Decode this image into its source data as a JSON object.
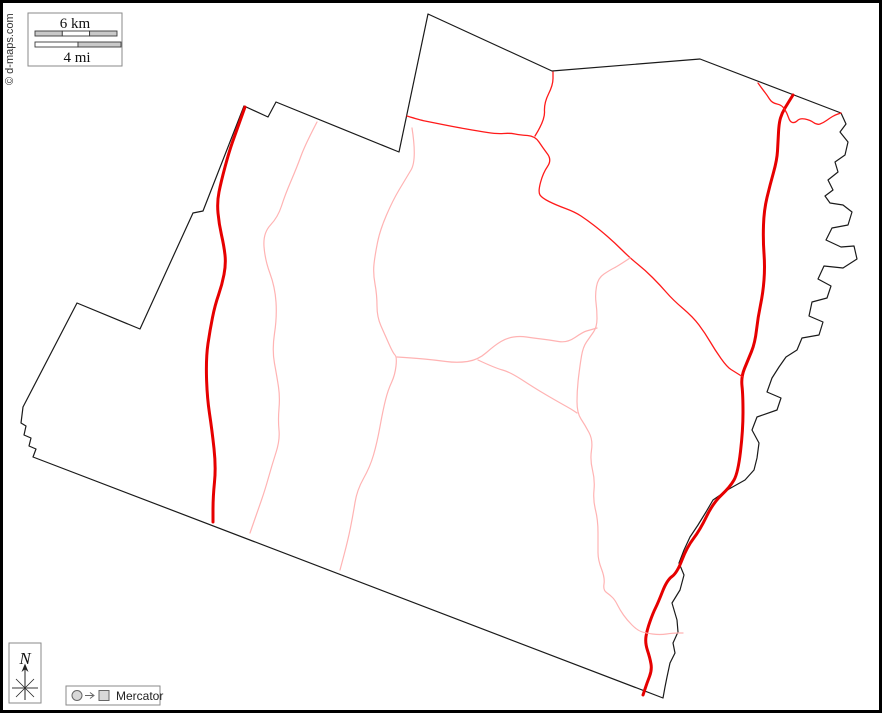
{
  "copyright": "© d-maps.com",
  "scale_bar": {
    "km_label": "6 km",
    "mi_label": "4 mi"
  },
  "north_label": "N",
  "projection_label": "Mercator",
  "colors": {
    "frame": "#000000",
    "boundary": "#1a1a1a",
    "road_major": "#e60000",
    "road_minor": "#ff1a1a",
    "road_light": "#ffb3b3"
  },
  "stroke_widths": {
    "boundary": 1.2,
    "road_major": 3,
    "road_minor": 1.3,
    "road_light": 1.2
  },
  "map": {
    "width": 882,
    "height": 713,
    "features": [
      {
        "name": "county-boundary",
        "layer": "boundary",
        "closed": true,
        "smooth": false,
        "points": [
          [
            244,
            106
          ],
          [
            268,
            117
          ],
          [
            276,
            102
          ],
          [
            399,
            152
          ],
          [
            428,
            14
          ],
          [
            552,
            71
          ],
          [
            700,
            59
          ],
          [
            841,
            113
          ],
          [
            846,
            124
          ],
          [
            840,
            132
          ],
          [
            848,
            142
          ],
          [
            845,
            155
          ],
          [
            835,
            162
          ],
          [
            838,
            172
          ],
          [
            828,
            180
          ],
          [
            833,
            190
          ],
          [
            825,
            196
          ],
          [
            830,
            203
          ],
          [
            843,
            205
          ],
          [
            852,
            212
          ],
          [
            848,
            225
          ],
          [
            832,
            228
          ],
          [
            826,
            240
          ],
          [
            841,
            247
          ],
          [
            854,
            246
          ],
          [
            857,
            259
          ],
          [
            843,
            268
          ],
          [
            824,
            266
          ],
          [
            818,
            279
          ],
          [
            831,
            286
          ],
          [
            827,
            298
          ],
          [
            812,
            302
          ],
          [
            809,
            316
          ],
          [
            823,
            322
          ],
          [
            819,
            335
          ],
          [
            802,
            338
          ],
          [
            797,
            350
          ],
          [
            786,
            357
          ],
          [
            779,
            367
          ],
          [
            772,
            378
          ],
          [
            767,
            392
          ],
          [
            781,
            398
          ],
          [
            777,
            410
          ],
          [
            757,
            417
          ],
          [
            752,
            430
          ],
          [
            759,
            443
          ],
          [
            757,
            458
          ],
          [
            754,
            470
          ],
          [
            745,
            480
          ],
          [
            729,
            489
          ],
          [
            713,
            500
          ],
          [
            706,
            512
          ],
          [
            698,
            525
          ],
          [
            690,
            537
          ],
          [
            684,
            550
          ],
          [
            679,
            563
          ],
          [
            684,
            575
          ],
          [
            680,
            590
          ],
          [
            672,
            603
          ],
          [
            677,
            620
          ],
          [
            678,
            632
          ],
          [
            673,
            643
          ],
          [
            675,
            653
          ],
          [
            670,
            663
          ],
          [
            667,
            677
          ],
          [
            665,
            687
          ],
          [
            663,
            698
          ],
          [
            33,
            457
          ],
          [
            36,
            449
          ],
          [
            29,
            446
          ],
          [
            31,
            438
          ],
          [
            24,
            435
          ],
          [
            26,
            426
          ],
          [
            21,
            423
          ],
          [
            23,
            407
          ],
          [
            77,
            303
          ],
          [
            140,
            329
          ],
          [
            193,
            213
          ],
          [
            203,
            211
          ]
        ]
      },
      {
        "name": "major-road-west",
        "layer": "road_major",
        "closed": false,
        "smooth": true,
        "points": [
          [
            245,
            107
          ],
          [
            236,
            132
          ],
          [
            229,
            152
          ],
          [
            221,
            182
          ],
          [
            217,
            202
          ],
          [
            219,
            224
          ],
          [
            224,
            246
          ],
          [
            226,
            264
          ],
          [
            222,
            285
          ],
          [
            215,
            305
          ],
          [
            210,
            330
          ],
          [
            206,
            357
          ],
          [
            207,
            397
          ],
          [
            212,
            430
          ],
          [
            216,
            467
          ],
          [
            213,
            497
          ],
          [
            213,
            522
          ]
        ]
      },
      {
        "name": "major-road-east",
        "layer": "road_major",
        "closed": false,
        "smooth": true,
        "points": [
          [
            793,
            95
          ],
          [
            788,
            103
          ],
          [
            782,
            113
          ],
          [
            779,
            123
          ],
          [
            778,
            142
          ],
          [
            777,
            160
          ],
          [
            770,
            185
          ],
          [
            764,
            210
          ],
          [
            763,
            240
          ],
          [
            765,
            267
          ],
          [
            763,
            293
          ],
          [
            758,
            317
          ],
          [
            755,
            343
          ],
          [
            748,
            360
          ],
          [
            741,
            377
          ],
          [
            743,
            395
          ],
          [
            743,
            430
          ],
          [
            738,
            473
          ],
          [
            730,
            487
          ],
          [
            713,
            503
          ],
          [
            700,
            530
          ],
          [
            687,
            547
          ],
          [
            677,
            573
          ],
          [
            667,
            580
          ],
          [
            658,
            603
          ],
          [
            653,
            613
          ],
          [
            647,
            630
          ],
          [
            645,
            643
          ],
          [
            650,
            658
          ],
          [
            652,
            670
          ],
          [
            647,
            683
          ],
          [
            643,
            695
          ]
        ]
      },
      {
        "name": "minor-road-north",
        "layer": "road_minor",
        "closed": false,
        "smooth": true,
        "points": [
          [
            407,
            116
          ],
          [
            420,
            120
          ],
          [
            430,
            122
          ],
          [
            455,
            127
          ],
          [
            478,
            131
          ],
          [
            497,
            134
          ],
          [
            510,
            133
          ],
          [
            520,
            135
          ],
          [
            535,
            136
          ],
          [
            543,
            148
          ],
          [
            552,
            160
          ],
          [
            543,
            173
          ],
          [
            538,
            192
          ],
          [
            542,
            198
          ],
          [
            556,
            205
          ],
          [
            575,
            212
          ],
          [
            587,
            220
          ],
          [
            600,
            230
          ],
          [
            615,
            243
          ],
          [
            630,
            258
          ],
          [
            645,
            270
          ],
          [
            660,
            285
          ],
          [
            673,
            300
          ],
          [
            693,
            317
          ],
          [
            705,
            333
          ],
          [
            715,
            350
          ],
          [
            727,
            367
          ],
          [
            735,
            372
          ],
          [
            743,
            377
          ]
        ]
      },
      {
        "name": "minor-road-north-branch",
        "layer": "road_minor",
        "closed": false,
        "smooth": true,
        "points": [
          [
            535,
            136
          ],
          [
            545,
            120
          ],
          [
            544,
            103
          ],
          [
            553,
            85
          ],
          [
            553,
            72
          ]
        ]
      },
      {
        "name": "minor-road-ne-connector",
        "layer": "road_minor",
        "closed": false,
        "smooth": true,
        "points": [
          [
            758,
            83
          ],
          [
            763,
            90
          ],
          [
            767,
            95
          ],
          [
            772,
            103
          ],
          [
            782,
            105
          ],
          [
            787,
            113
          ],
          [
            790,
            122
          ],
          [
            795,
            123
          ],
          [
            800,
            118
          ],
          [
            810,
            120
          ],
          [
            817,
            125
          ],
          [
            823,
            123
          ],
          [
            830,
            118
          ],
          [
            835,
            115
          ],
          [
            841,
            113
          ]
        ]
      },
      {
        "name": "light-road-west",
        "layer": "road_light",
        "closed": false,
        "smooth": true,
        "points": [
          [
            317,
            122
          ],
          [
            305,
            145
          ],
          [
            297,
            167
          ],
          [
            285,
            195
          ],
          [
            278,
            217
          ],
          [
            263,
            233
          ],
          [
            265,
            260
          ],
          [
            275,
            287
          ],
          [
            277,
            317
          ],
          [
            272,
            350
          ],
          [
            277,
            377
          ],
          [
            280,
            397
          ],
          [
            278,
            420
          ],
          [
            280,
            440
          ],
          [
            272,
            465
          ],
          [
            265,
            490
          ],
          [
            258,
            510
          ],
          [
            250,
            533
          ]
        ]
      },
      {
        "name": "light-road-center",
        "layer": "road_light",
        "closed": false,
        "smooth": true,
        "points": [
          [
            412,
            128
          ],
          [
            417,
            160
          ],
          [
            405,
            180
          ],
          [
            393,
            200
          ],
          [
            380,
            230
          ],
          [
            375,
            255
          ],
          [
            373,
            273
          ],
          [
            377,
            295
          ],
          [
            377,
            317
          ],
          [
            385,
            335
          ],
          [
            393,
            353
          ],
          [
            397,
            357
          ],
          [
            395,
            375
          ],
          [
            388,
            390
          ],
          [
            383,
            410
          ],
          [
            377,
            443
          ],
          [
            370,
            467
          ],
          [
            357,
            490
          ],
          [
            353,
            515
          ],
          [
            348,
            540
          ],
          [
            340,
            570
          ]
        ]
      },
      {
        "name": "light-road-cross-east",
        "layer": "road_light",
        "closed": false,
        "smooth": true,
        "points": [
          [
            397,
            357
          ],
          [
            413,
            358
          ],
          [
            435,
            360
          ],
          [
            457,
            363
          ],
          [
            478,
            360
          ],
          [
            495,
            345
          ],
          [
            507,
            338
          ],
          [
            520,
            336
          ],
          [
            533,
            338
          ],
          [
            550,
            340
          ],
          [
            567,
            343
          ],
          [
            583,
            332
          ],
          [
            590,
            330
          ],
          [
            597,
            328
          ]
        ]
      },
      {
        "name": "light-road-cross-southeast",
        "layer": "road_light",
        "closed": false,
        "smooth": true,
        "points": [
          [
            478,
            360
          ],
          [
            495,
            368
          ],
          [
            510,
            372
          ],
          [
            533,
            387
          ],
          [
            548,
            396
          ],
          [
            562,
            404
          ],
          [
            571,
            409
          ],
          [
            577,
            413
          ]
        ]
      },
      {
        "name": "light-road-east",
        "layer": "road_light",
        "closed": false,
        "smooth": true,
        "points": [
          [
            630,
            258
          ],
          [
            618,
            266
          ],
          [
            610,
            270
          ],
          [
            598,
            278
          ],
          [
            595,
            295
          ],
          [
            597,
            310
          ],
          [
            597,
            327
          ],
          [
            590,
            337
          ],
          [
            583,
            347
          ],
          [
            580,
            365
          ],
          [
            577,
            390
          ],
          [
            577,
            413
          ],
          [
            585,
            425
          ],
          [
            593,
            440
          ],
          [
            590,
            460
          ],
          [
            595,
            480
          ],
          [
            593,
            500
          ],
          [
            598,
            520
          ],
          [
            598,
            545
          ],
          [
            598,
            560
          ],
          [
            605,
            578
          ],
          [
            603,
            590
          ],
          [
            610,
            595
          ],
          [
            615,
            600
          ],
          [
            620,
            610
          ],
          [
            627,
            620
          ],
          [
            637,
            630
          ],
          [
            645,
            633
          ],
          [
            660,
            635
          ],
          [
            673,
            633
          ],
          [
            683,
            633
          ]
        ]
      }
    ]
  }
}
